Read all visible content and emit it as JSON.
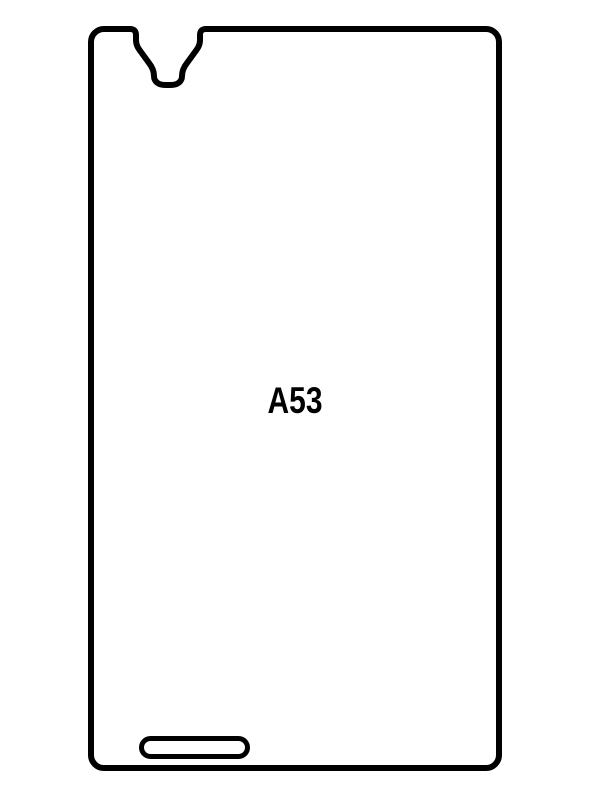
{
  "page": {
    "background_color": "#ffffff"
  },
  "protector": {
    "model_label": "A53",
    "outline_color": "#000000",
    "label_color": "#000000",
    "features": {
      "top_cutout": "earpiece-notch-cutout",
      "bottom_cutout": "speaker-slot-cutout"
    }
  }
}
